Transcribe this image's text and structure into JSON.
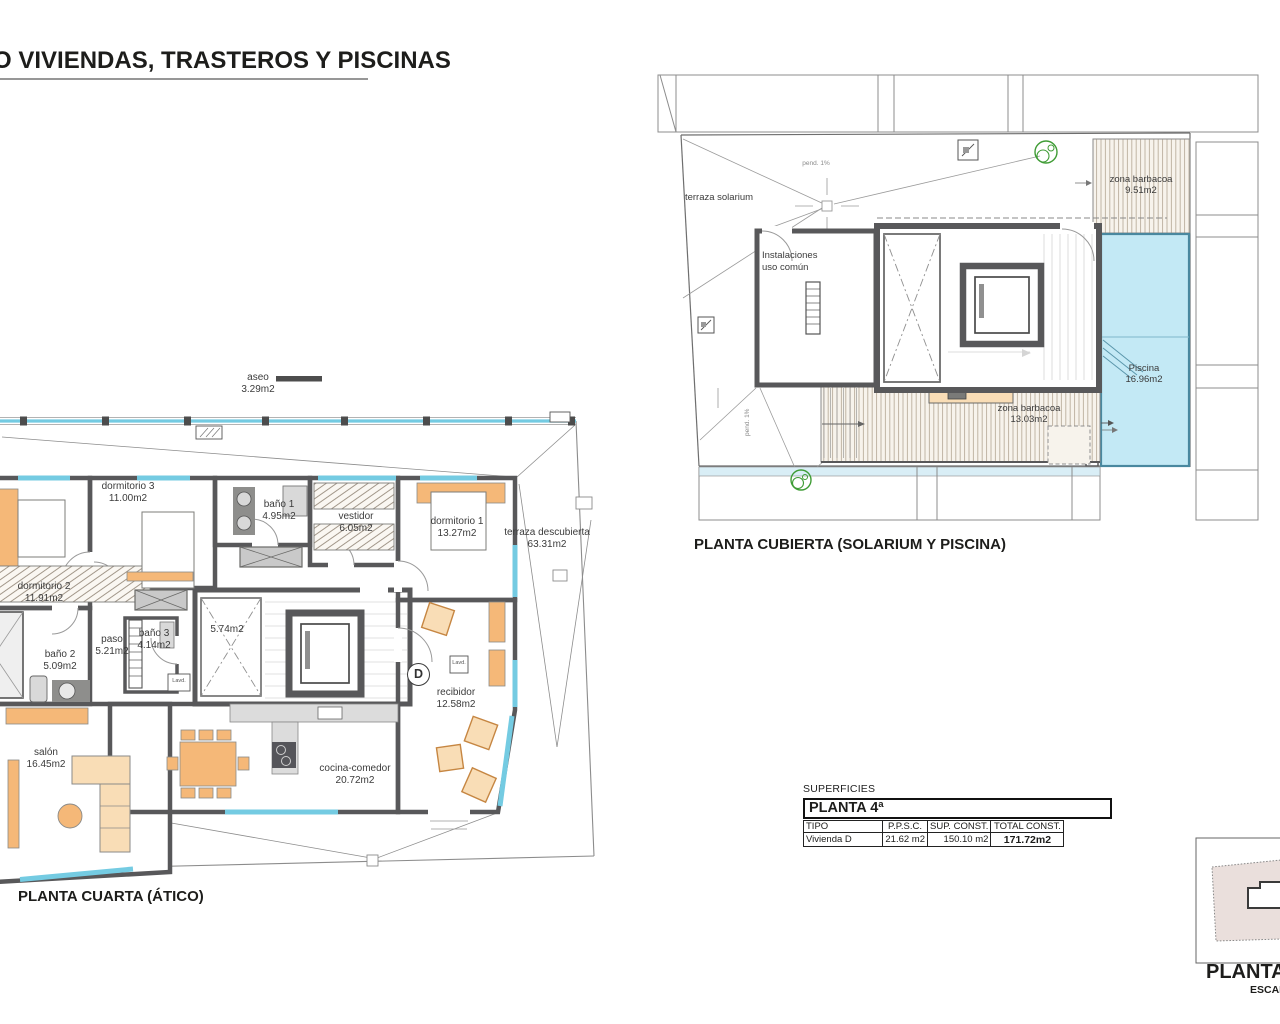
{
  "page": {
    "title": "O VIVIENDAS, TRASTEROS Y PISCINAS"
  },
  "plan_atico": {
    "caption": "PLANTA CUARTA (ÁTICO)",
    "unit_letter": "D",
    "rooms": {
      "aseo": {
        "name": "aseo",
        "area": "3.29m2"
      },
      "dorm3": {
        "name": "dormitorio 3",
        "area": "11.00m2"
      },
      "banyo1": {
        "name": "baño 1",
        "area": "4.95m2"
      },
      "vestidor": {
        "name": "vestidor",
        "area": "6.05m2"
      },
      "dorm1": {
        "name": "dormitorio 1",
        "area": "13.27m2"
      },
      "terraza": {
        "name": "terraza descubierta",
        "area": "63.31m2"
      },
      "dorm2": {
        "name": "dormitorio 2",
        "area": "11.91m2"
      },
      "paso": {
        "name": "paso",
        "area": "5.21m2"
      },
      "banyo3": {
        "name": "baño 3",
        "area": "4.14m2"
      },
      "banyo2": {
        "name": "baño 2",
        "area": "5.09m2"
      },
      "escalera": {
        "area": "5.74m2"
      },
      "salon": {
        "name": "salón",
        "area": "16.45m2"
      },
      "cocina": {
        "name": "cocina-comedor",
        "area": "20.72m2"
      },
      "recibidor": {
        "name": "recibidor",
        "area": "12.58m2"
      },
      "lavadero": {
        "name": "Lavd."
      }
    }
  },
  "plan_cubierta": {
    "caption": "PLANTA CUBIERTA (SOLARIUM Y PISCINA)",
    "rooms": {
      "solarium": {
        "name": "terraza solarium"
      },
      "instalaciones": {
        "name": "Instalaciones",
        "name2": "uso común"
      },
      "barbacoa1": {
        "name": "zona barbacoa",
        "area": "9.51m2"
      },
      "piscina": {
        "name": "Piscina",
        "area": "16.96m2"
      },
      "barbacoa2": {
        "name": "zona barbacoa",
        "area": "13.03m2"
      }
    },
    "annotations": {
      "slope": "pend. 1%"
    }
  },
  "summary": {
    "label": "SUPERFICIES",
    "floor_title": "PLANTA 4ª",
    "col_tipo": "TIPO",
    "col_ppsc": "P.P.S.C.",
    "col_sup": "SUP. CONST.",
    "col_total": "TOTAL CONST.",
    "row_tipo": "Vivienda D",
    "row_ppsc": "21.62 m2",
    "row_sup": "150.10 m2",
    "row_total": "171.72m2"
  },
  "keyplan": {
    "caption": "PLANTA CU",
    "scale": "ESCAL"
  },
  "colors": {
    "wall": "#58585a",
    "glass": "#74cbe2",
    "pool": "#c3e9f5",
    "furniture": "#f5b878",
    "drain_green": "#3f9c35"
  }
}
